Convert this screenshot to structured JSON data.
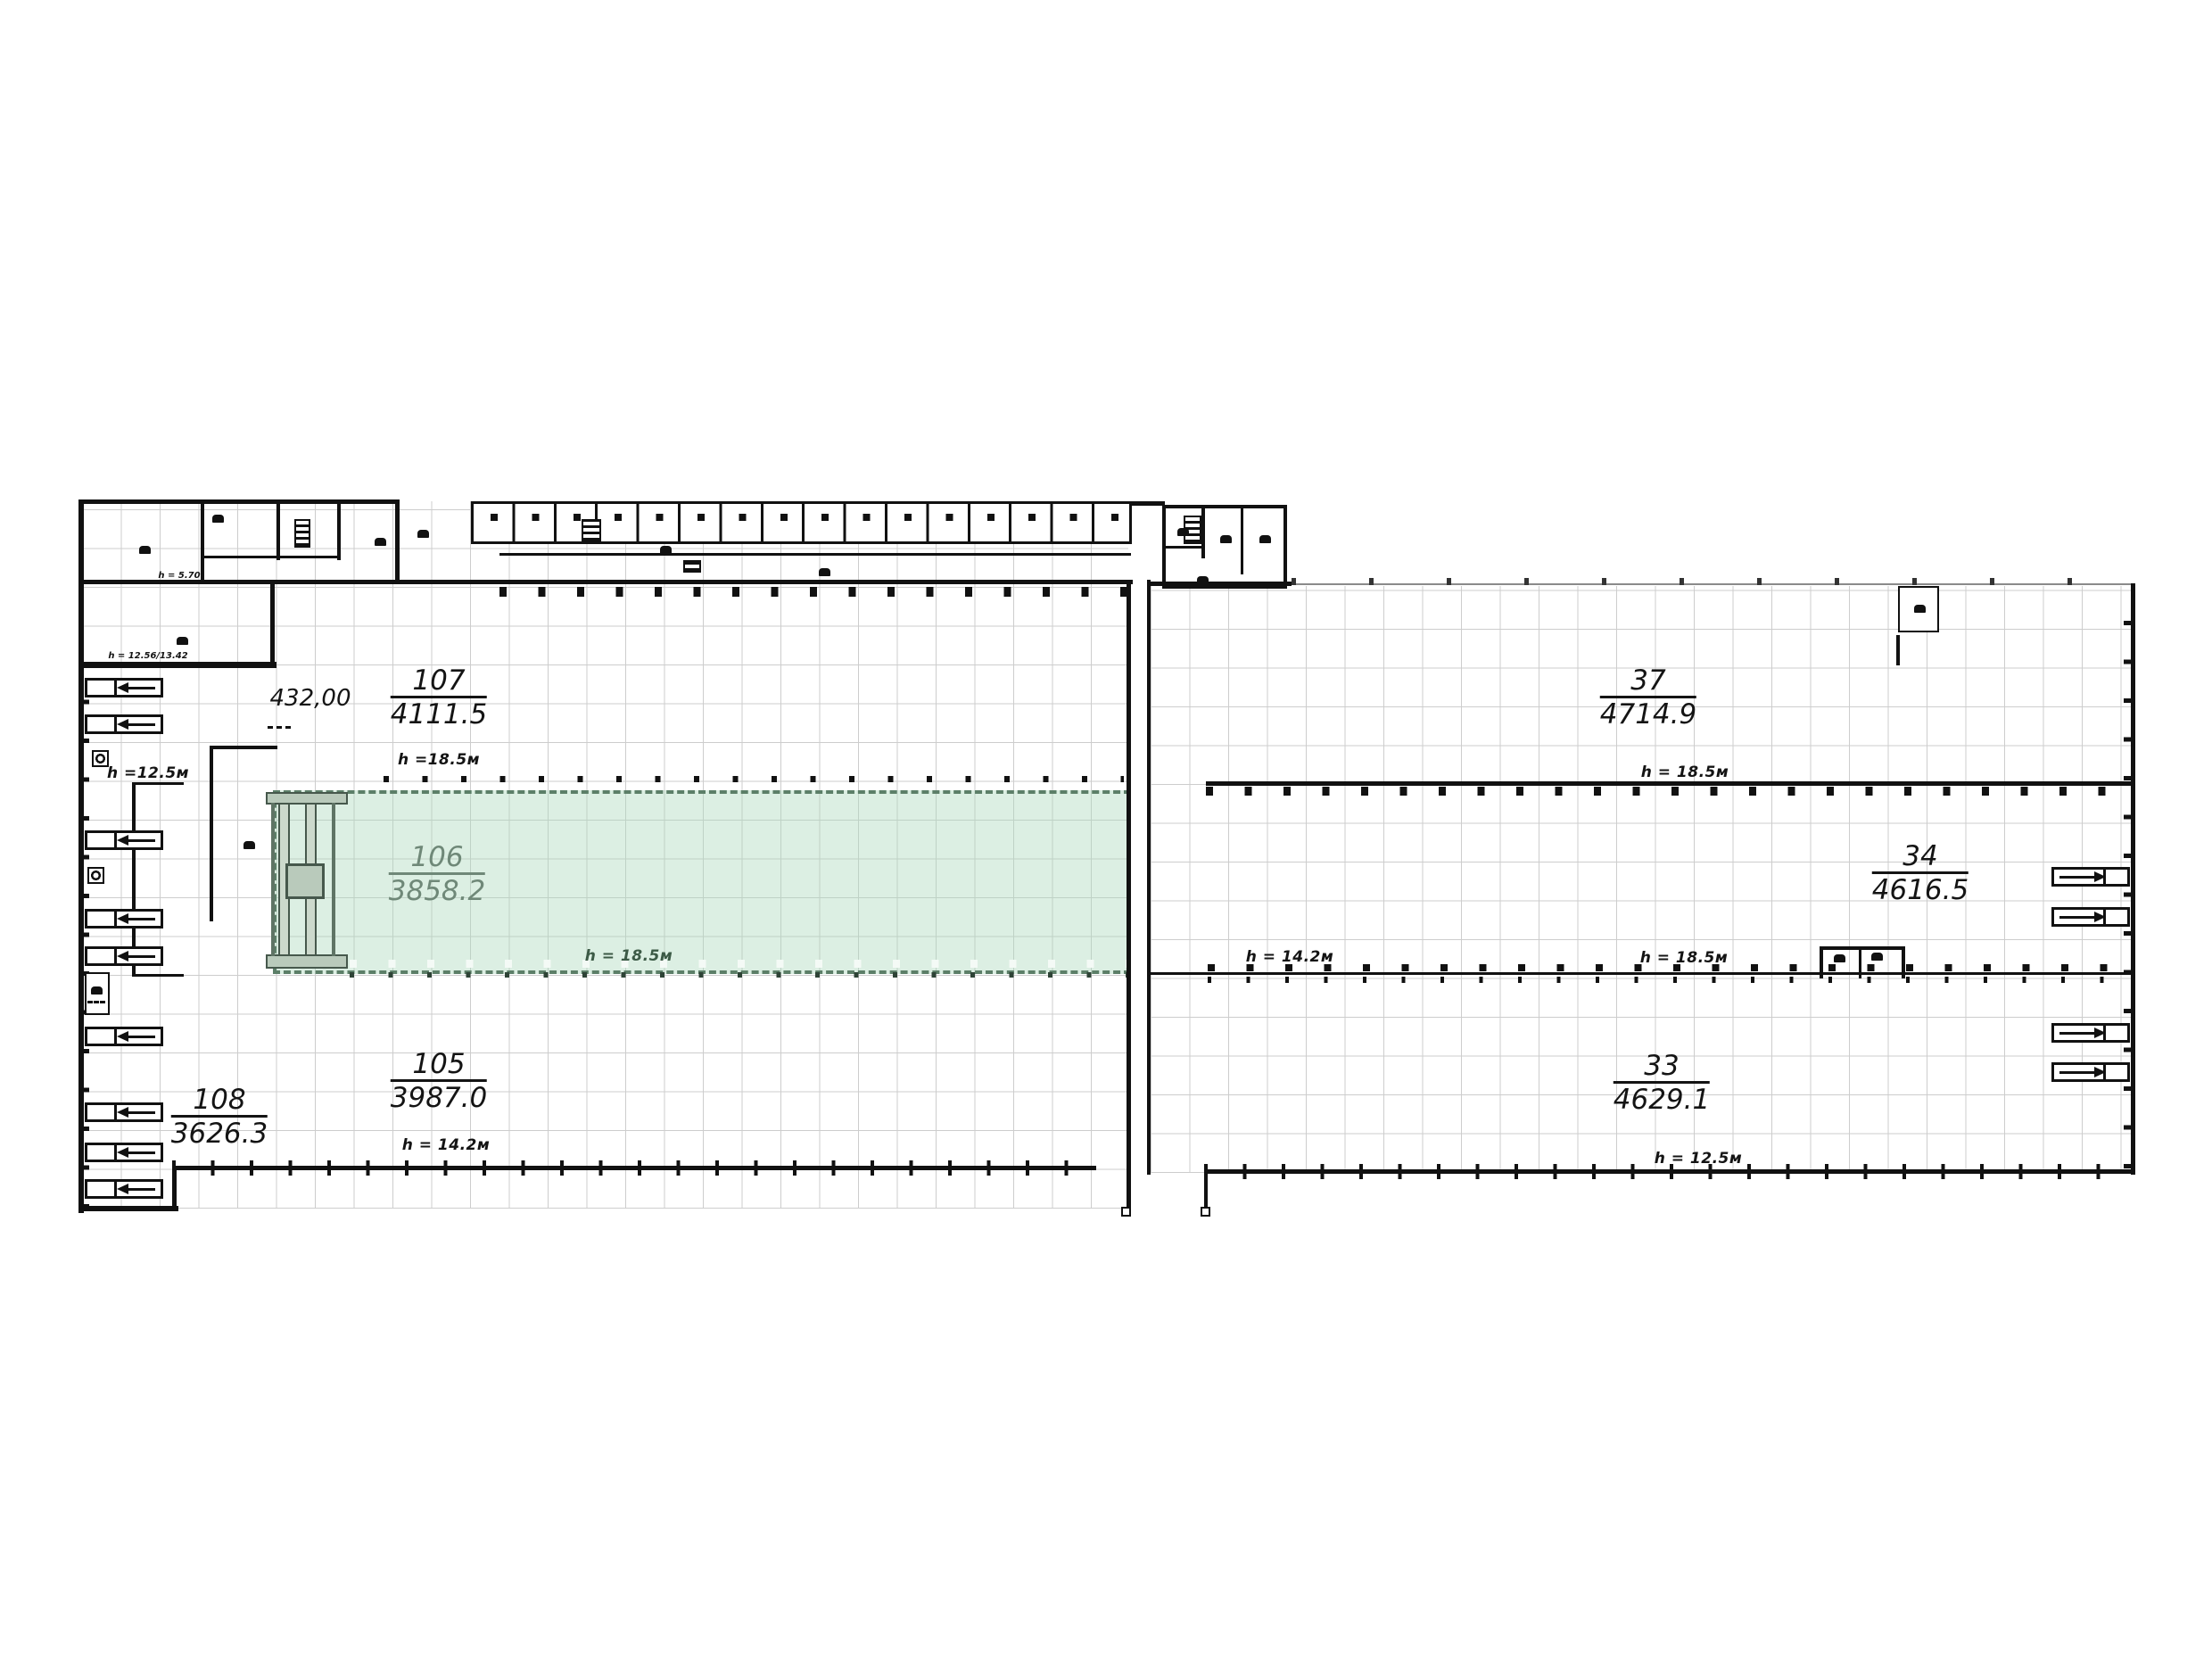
{
  "plan": {
    "rooms": [
      {
        "number": "107",
        "area": "4111.5",
        "height": "h =18.5м"
      },
      {
        "number": "106",
        "area": "3858.2",
        "height": "h = 18.5м",
        "highlighted": true
      },
      {
        "number": "105",
        "area": "3987.0",
        "height": "h = 14.2м"
      },
      {
        "number": "108",
        "area": "3626.3"
      },
      {
        "number": "37",
        "area": "4714.9",
        "height": "h = 18.5м"
      },
      {
        "number": "34",
        "area": "4616.5"
      },
      {
        "number": "33",
        "area": "4629.1",
        "height": "h = 12.5м"
      }
    ],
    "annotations": {
      "elevation_mark": "432,00",
      "left_wing_height": "h =12.5м",
      "mezzanine_height": "h = 5.70",
      "lower_block_height": "h = 12.56/13.42",
      "bay_height_left": "h = 14.2м",
      "bay_height_right": "h = 18.5м"
    },
    "colors": {
      "highlight_fill": "#d9eee1",
      "highlight_border": "#5c7f68",
      "highlight_text": "#6f8878",
      "wall": "#111111",
      "grid": "#cccccc"
    }
  }
}
